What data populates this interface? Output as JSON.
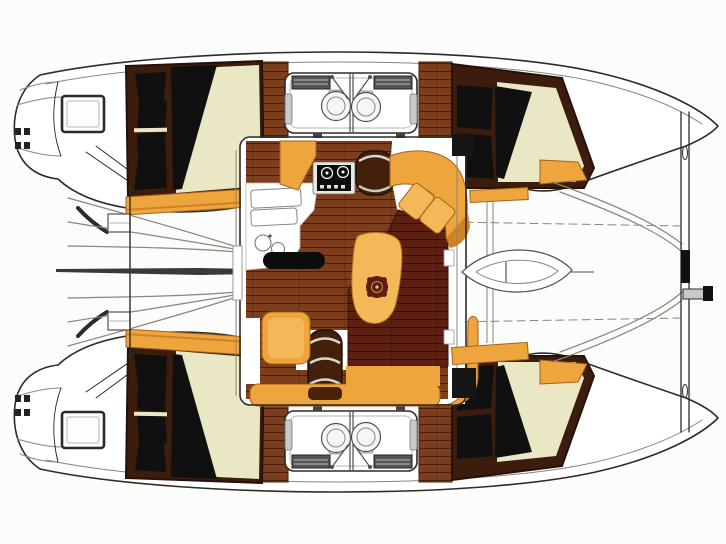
{
  "meta": {
    "description": "Top-down interior floor plan line drawing of a four-cabin sailing catamaran, bows to the right, transom swim steps to the left",
    "canvas": {
      "width": 726,
      "height": 544
    }
  },
  "palette": {
    "outline": "#2f2a26",
    "line_soft": "#8a857e",
    "wood_medium": "#7d3e1d",
    "wood_dark": "#5c2113",
    "frame_dark": "#3c1c0c",
    "mattress": "#eae7c4",
    "pillow": "#101010",
    "orange": "#efa53d",
    "orange_light": "#f5b859",
    "orange_dark": "#cf8327",
    "orange_edge": "#a3611c",
    "steel": "#c9c9c9",
    "black_fixture": "#0c0c0c",
    "paper": "#fcfcfb"
  },
  "regions": {
    "port_hull": "Port hull",
    "starboard_hull": "Starboard hull",
    "salon": "Salon with galley and dinette",
    "galley": "Galley with twin sinks and two-burner stove",
    "dinette": "Dinette table with orange upholstered seating",
    "aft_deck": "Aft deck between transom swim steps",
    "foredeck": "Foredeck nacelle",
    "trampoline": "Bow trampoline area",
    "crossbeam": "Forward crossbeam with bowsprit fitting",
    "aft_cabin": "Aft double cabin (black pillows, cream berth, orange shelf)",
    "fwd_cabin": "Forward double cabin (black pillows, cream berth)",
    "heads": "Two back-to-back heads with WC and counter"
  },
  "visible_counts": {
    "double_berths": 4,
    "toilets": 4,
    "stove_burners": 2,
    "galley_sinks": 2
  }
}
